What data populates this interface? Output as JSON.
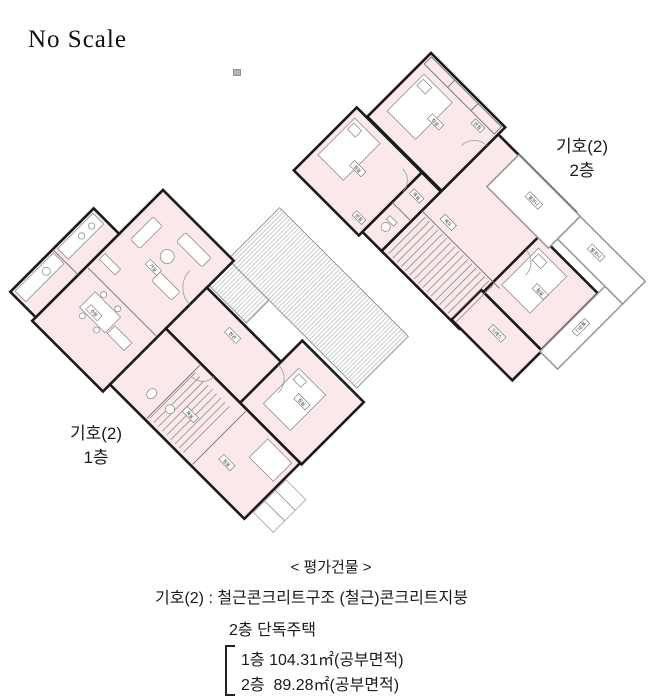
{
  "document": {
    "scale_note": "No Scale"
  },
  "plans": {
    "plan1": {
      "caption_line1": "기호(2)",
      "caption_line2": "1층",
      "room_labels": [
        {
          "text": "거실"
        },
        {
          "text": "주방"
        },
        {
          "text": "현관"
        },
        {
          "text": "침실"
        },
        {
          "text": "욕실"
        },
        {
          "text": "침실"
        }
      ]
    },
    "plan2": {
      "caption_line1": "기호(2)",
      "caption_line2": "2층",
      "room_labels": [
        {
          "text": "침실"
        },
        {
          "text": "반침"
        },
        {
          "text": "침실"
        },
        {
          "text": "반침"
        },
        {
          "text": "욕실"
        },
        {
          "text": "복도"
        },
        {
          "text": "침실"
        },
        {
          "text": "드레스"
        },
        {
          "text": "발코니"
        },
        {
          "text": "발코니"
        },
        {
          "text": "발코니"
        }
      ]
    }
  },
  "footer": {
    "title": "< 평가건물 >",
    "structure_line": "기호(2) : 철근콘크리트구조 (철근)콘크리트지붕",
    "building_line": "2층 단독주택",
    "area_line1": "1층 104.31㎡(공부면적)",
    "area_line2": "2층  89.28㎡(공부면적)"
  },
  "colors": {
    "room_fill": "#fbe9e9",
    "wall": "#1a1a1a",
    "balcony_wall": "#9a9a9a",
    "hatch_line": "#aaaaaa",
    "text": "#222222"
  }
}
